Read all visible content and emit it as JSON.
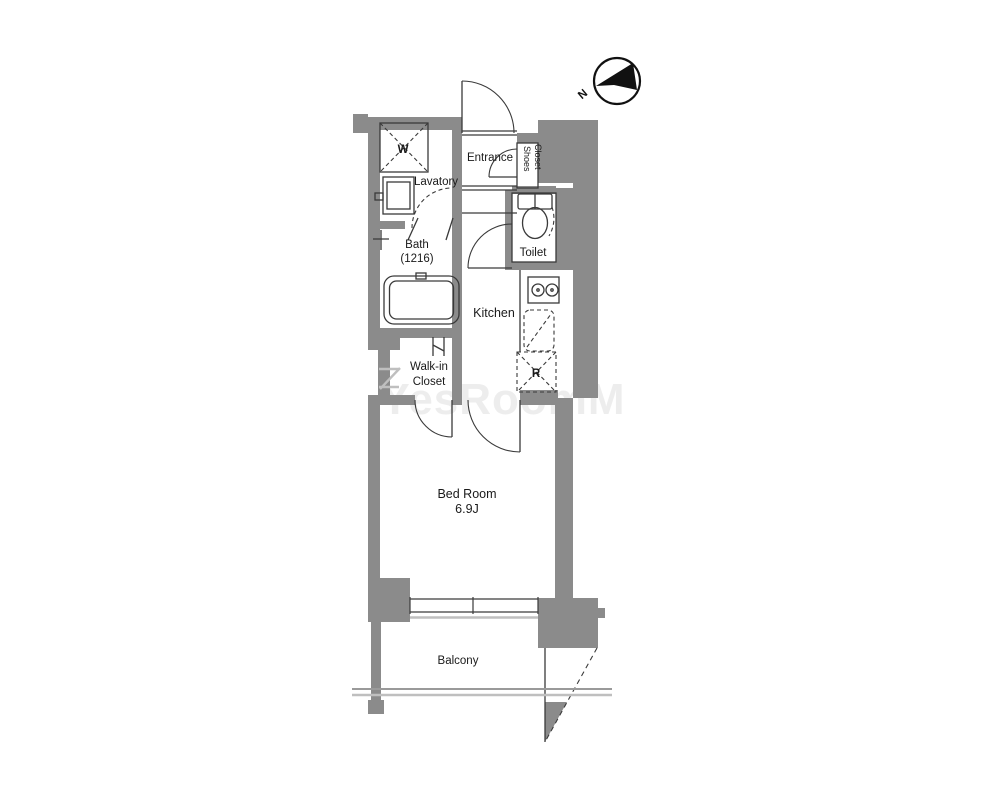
{
  "colors": {
    "wall": "#8b8b8b",
    "outline": "#3a3a3a",
    "light": "#bfbfbf",
    "rail": "#9a9a9a",
    "text": "#1a1a1a",
    "compass": "#111111",
    "watermark": "#e0e0e0",
    "background": "#ffffff"
  },
  "compass": {
    "label": "N"
  },
  "watermark": {
    "text": "YesRoomM"
  },
  "rooms": {
    "entrance": {
      "label": "Entrance"
    },
    "shoes_closet": {
      "line1": "Shoes",
      "line2": "Closet"
    },
    "toilet": {
      "label": "Toilet"
    },
    "lavatory": {
      "label": "Lavatory"
    },
    "bath": {
      "line1": "Bath",
      "line2": "(1216)"
    },
    "kitchen": {
      "label": "Kitchen"
    },
    "walk_in_closet": {
      "line1": "Walk-in",
      "line2": "Closet"
    },
    "bedroom": {
      "line1": "Bed Room",
      "line2": "6.9J"
    },
    "balcony": {
      "label": "Balcony"
    }
  },
  "fixtures": {
    "washer_label": "W",
    "refrigerator_label": "R"
  }
}
